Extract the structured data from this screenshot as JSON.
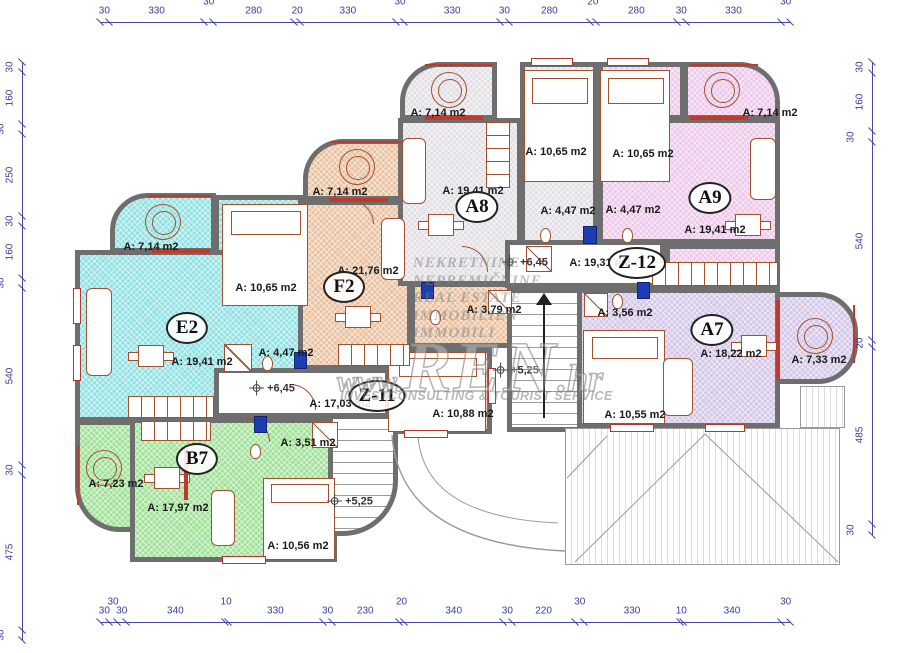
{
  "watermark": {
    "lines": [
      "NEKRETNINE",
      "NEPREMIČNINE",
      "REAL ESTATE",
      "IMMOBILIEN",
      "IMMOBILI"
    ],
    "brand_www": "www.",
    "brand_name": "REN",
    "brand_tld": ".hr",
    "tagline": "INVESTCONSULTING & TOURIST SERVICE"
  },
  "floorplan": {
    "apartments": [
      {
        "id": "E2",
        "color": "#92e2e4",
        "circle": {
          "x": 187,
          "y": 328
        },
        "rooms": [
          {
            "label": "A: 7,14 m2",
            "x": 151,
            "y": 247
          },
          {
            "label": "A: 10,65 m2",
            "x": 266,
            "y": 288
          },
          {
            "label": "A: 19,41 m2",
            "x": 202,
            "y": 362
          },
          {
            "label": "A: 4,47 m2",
            "x": 286,
            "y": 353
          }
        ]
      },
      {
        "id": "F2",
        "color": "#eac2a0",
        "circle": {
          "x": 344,
          "y": 287
        },
        "rooms": [
          {
            "label": "A: 7,14 m2",
            "x": 340,
            "y": 192
          },
          {
            "label": "A: 21,76 m2",
            "x": 368,
            "y": 271
          },
          {
            "label": "A: 3,79 m2",
            "x": 494,
            "y": 310
          },
          {
            "label": "A: 10,88 m2",
            "x": 463,
            "y": 414
          }
        ]
      },
      {
        "id": "A8",
        "color": "#e2e0e4",
        "circle": {
          "x": 477,
          "y": 207
        },
        "rooms": [
          {
            "label": "A: 7,14 m2",
            "x": 438,
            "y": 113
          },
          {
            "label": "A: 10,65 m2",
            "x": 556,
            "y": 152
          },
          {
            "label": "A: 19,41 m2",
            "x": 473,
            "y": 191
          },
          {
            "label": "A: 4,47 m2",
            "x": 568,
            "y": 211
          }
        ]
      },
      {
        "id": "A9",
        "color": "#edc9ea",
        "circle": {
          "x": 710,
          "y": 198
        },
        "rooms": [
          {
            "label": "A: 7,14 m2",
            "x": 770,
            "y": 113
          },
          {
            "label": "A: 10,65 m2",
            "x": 643,
            "y": 154
          },
          {
            "label": "A: 4,47 m2",
            "x": 633,
            "y": 210
          },
          {
            "label": "A: 19,41 m2",
            "x": 715,
            "y": 230
          }
        ]
      },
      {
        "id": "A7",
        "color": "#d4c7e8",
        "circle": {
          "x": 712,
          "y": 330
        },
        "rooms": [
          {
            "label": "A: 3,56 m2",
            "x": 625,
            "y": 313
          },
          {
            "label": "A: 18,22 m2",
            "x": 731,
            "y": 354
          },
          {
            "label": "A: 7,33 m2",
            "x": 819,
            "y": 360
          },
          {
            "label": "A: 10,55 m2",
            "x": 635,
            "y": 415
          }
        ]
      },
      {
        "id": "B7",
        "color": "#a0e298",
        "circle": {
          "x": 197,
          "y": 459
        },
        "rooms": [
          {
            "label": "A: 7,23 m2",
            "x": 116,
            "y": 484
          },
          {
            "label": "A: 3,51 m2",
            "x": 308,
            "y": 443
          },
          {
            "label": "A: 17,97 m2",
            "x": 178,
            "y": 508
          },
          {
            "label": "A: 10,56 m2",
            "x": 298,
            "y": 546
          }
        ]
      },
      {
        "id": "Z-11",
        "color": "#ffffff",
        "circle": {
          "x": 377,
          "y": 396
        },
        "rooms": [
          {
            "label": "A: 17,03 m2",
            "x": 340,
            "y": 404
          }
        ]
      },
      {
        "id": "Z-12",
        "color": "#ffffff",
        "circle": {
          "x": 637,
          "y": 263
        },
        "rooms": [
          {
            "label": "A: 19,31 m2",
            "x": 600,
            "y": 263
          }
        ]
      }
    ],
    "levels": [
      {
        "text": "+6,45",
        "x": 272,
        "y": 388
      },
      {
        "text": "+6,45",
        "x": 525,
        "y": 262
      },
      {
        "text": "+5,25",
        "x": 516,
        "y": 370
      },
      {
        "text": "+5,25",
        "x": 350,
        "y": 501
      }
    ],
    "dimensions": {
      "top": [
        30,
        330,
        30,
        280,
        20,
        330,
        30,
        330,
        30,
        280,
        20,
        280,
        30,
        330,
        30
      ],
      "bottom": [
        30,
        30,
        30,
        340,
        10,
        330,
        30,
        230,
        20,
        340,
        30,
        220,
        30,
        330,
        10,
        340,
        30
      ],
      "left": [
        30,
        160,
        30,
        250,
        30,
        160,
        30,
        540,
        30,
        475,
        30
      ],
      "right": [
        30,
        160,
        30,
        540,
        20,
        485,
        30
      ]
    },
    "wall_color": "#6f6e6e",
    "dimension_color": "#3b3b9b",
    "accent_red": "#b03a2e"
  }
}
